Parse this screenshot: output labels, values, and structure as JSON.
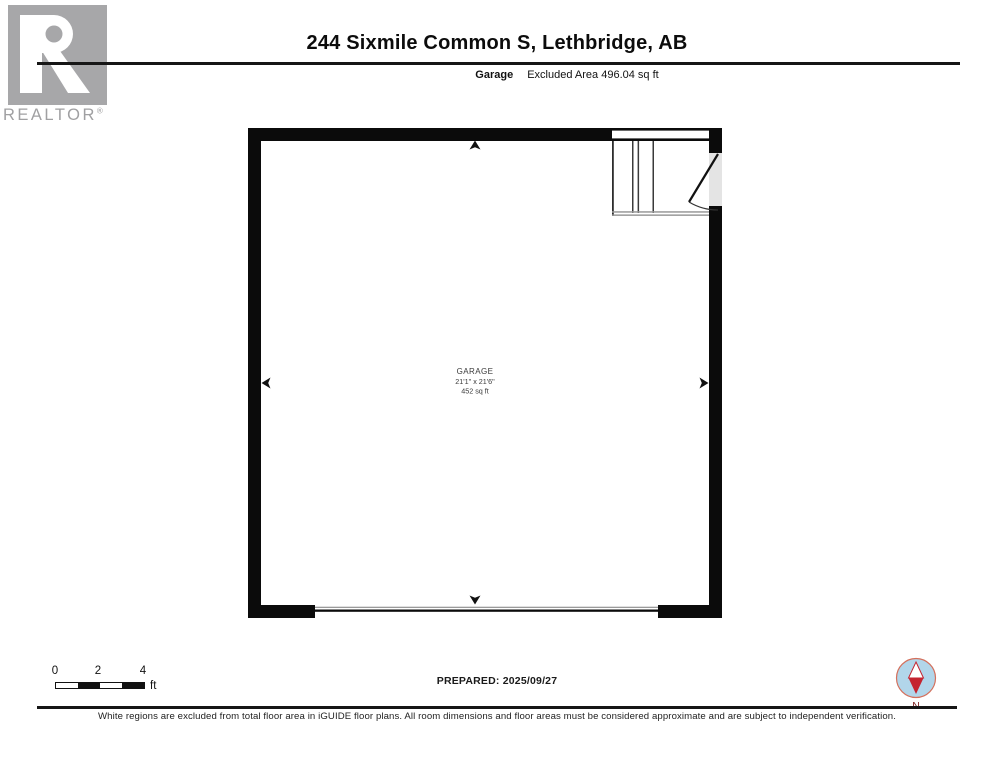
{
  "header": {
    "title": "244 Sixmile Common S, Lethbridge, AB",
    "floor_label": "Garage",
    "excluded_area": "Excluded Area 496.04 sq ft",
    "logo_word": "REALTOR",
    "logo_registered_mark": "®"
  },
  "floor_plan": {
    "room": {
      "name": "GARAGE",
      "dimensions": "21'1\" x 21'6\"",
      "area": "452 sq ft"
    },
    "features": [
      "stairs",
      "entry-door",
      "garage-door-opening",
      "dimension-arrows"
    ],
    "colors": {
      "wall": "#0b0b0b",
      "stair_edge_gray": "#999999",
      "door_threshold": "#e4e4e4"
    }
  },
  "footer": {
    "scale": {
      "ticks": [
        "0",
        "2",
        "4"
      ],
      "unit": "ft"
    },
    "prepared": "PREPARED: 2025/09/27",
    "compass": {
      "label": "N",
      "needle_red": "#c42430",
      "disc_blue": "#b2d6ea"
    },
    "disclaimer": "White regions are excluded from total floor area in iGUIDE floor plans. All room dimensions and floor areas must be considered approximate and are subject to independent verification."
  }
}
